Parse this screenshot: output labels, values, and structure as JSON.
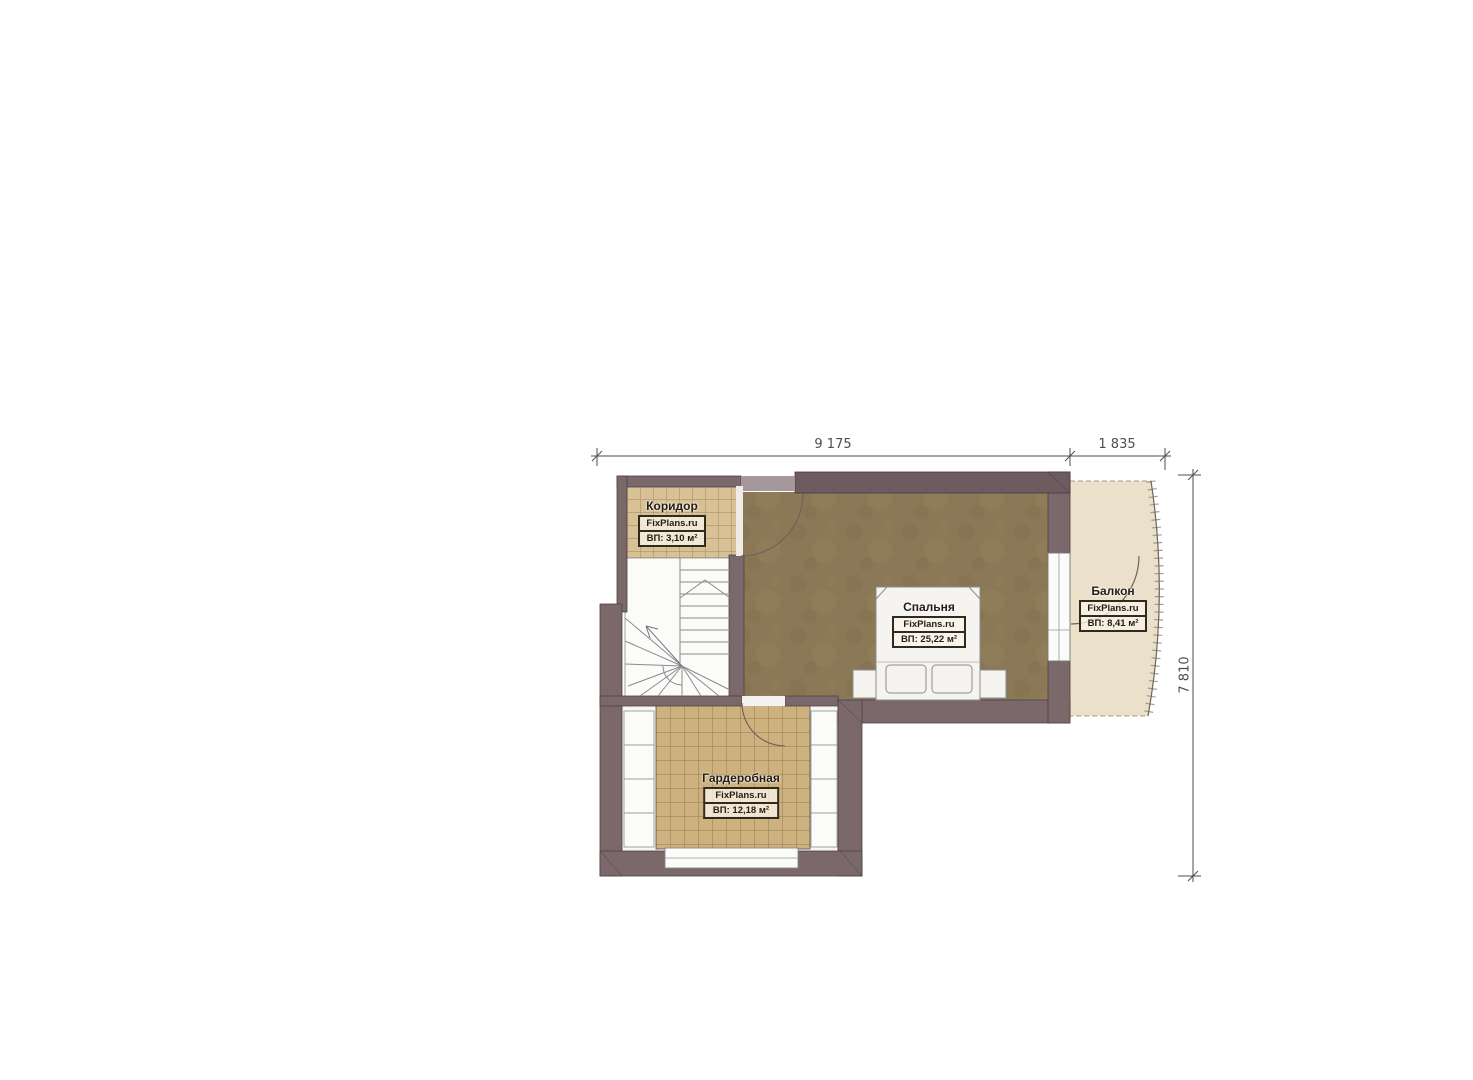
{
  "plan": {
    "dimensions": {
      "width_main": "9 175",
      "width_balcony": "1 835",
      "height_right": "7 810"
    },
    "rooms": [
      {
        "key": "koridor",
        "name": "Коридор",
        "brand": "FixPlans.ru",
        "area": "ВП: 3,10 м²"
      },
      {
        "key": "spalnya",
        "name": "Спальня",
        "brand": "FixPlans.ru",
        "area": "ВП: 25,22 м²"
      },
      {
        "key": "balkon",
        "name": "Балкон",
        "brand": "FixPlans.ru",
        "area": "ВП: 8,41 м²"
      },
      {
        "key": "garderobnaya",
        "name": "Гардеробная",
        "brand": "FixPlans.ru",
        "area": "ВП: 12,18 м²"
      }
    ],
    "colors": {
      "wall": "#7b686b",
      "wall_heavy": "#6e5b5f",
      "wall_lintel": "#a5979a",
      "bedroom_floor": "#8b7856",
      "corridor_tile": "#d8c195",
      "wardrobe_tile": "#cdb17e",
      "balcony_floor": "#ebe0ca",
      "white_room": "#fbfbfa",
      "dimension_text": "#4d4d4d"
    }
  }
}
